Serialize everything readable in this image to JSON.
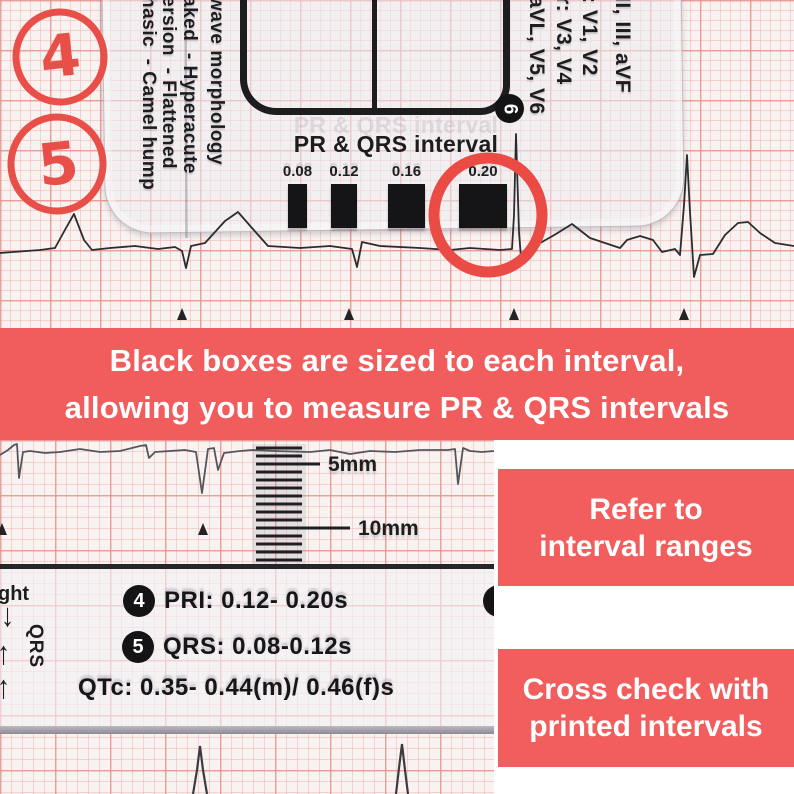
{
  "banner": {
    "line1": "Black boxes are sized to each interval,",
    "line2": "allowing you to measure PR & QRS intervals"
  },
  "step_annotations": {
    "circle_4": "4",
    "circle_5": "5"
  },
  "ruler_top": {
    "heading": "PR & QRS interval",
    "badge": "6",
    "morphology_lines": [
      "wave morphology",
      "aked  - Hyperacute",
      "ersion  - Flattened",
      "hasic  - Camel hump"
    ],
    "lead_lines": [
      "II, III, aVF",
      ": V1, V2",
      "r: V3, V4",
      "aVL, V5, V6"
    ],
    "intervals": [
      {
        "label": "0.08",
        "width": 19,
        "left": 288
      },
      {
        "label": "0.12",
        "width": 26,
        "left": 331
      },
      {
        "label": "0.16",
        "width": 37,
        "left": 388
      },
      {
        "label": "0.20",
        "width": 48,
        "left": 459
      }
    ]
  },
  "ruler_bottom": {
    "scale_5mm": "5mm",
    "scale_10mm": "10mm",
    "edge_text": "ght",
    "arrow_down": "↓",
    "arrow_up": "↑",
    "rotated_text": "QRS",
    "rows": [
      {
        "badge": "4",
        "text": "PRI: 0.12- 0.20s"
      },
      {
        "badge": "5",
        "text": "QRS: 0.08-0.12s"
      }
    ],
    "qtc_text": "QTc: 0.35- 0.44(m)/ 0.46(f)s",
    "partial_badge": "7"
  },
  "side_notes": [
    {
      "line1": "Refer to",
      "line2": "interval ranges"
    },
    {
      "line1": "Cross check with",
      "line2": "printed intervals"
    }
  ],
  "colors": {
    "accent_coral": "#f15c5c",
    "marker_red": "#e84f48",
    "ink_black": "#1d1d1f"
  }
}
